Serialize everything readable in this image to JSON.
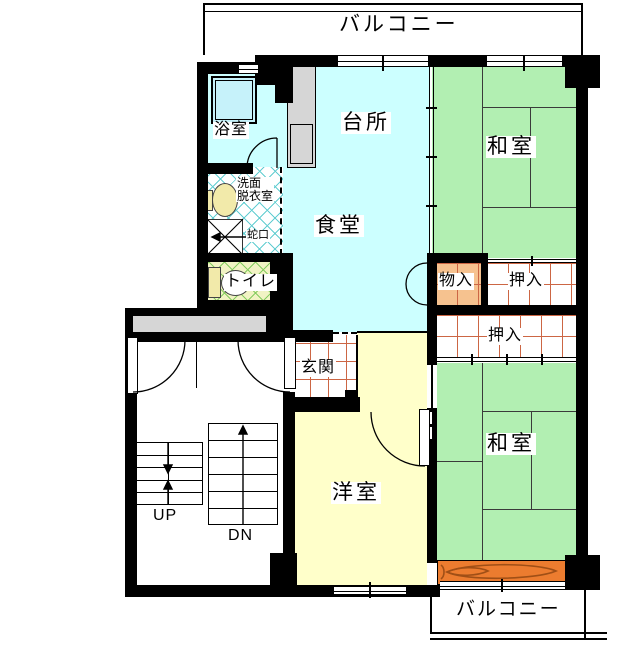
{
  "title": "apartment-floor-plan",
  "labels": {
    "balcony_top": "バルコニー",
    "balcony_bottom": "バルコニー",
    "bathroom": "浴室",
    "kitchen": "台所",
    "dining": "食堂",
    "washitsu_top": "和室",
    "washitsu_bottom": "和室",
    "western_room": "洋室",
    "washroom_line1": "洗面",
    "washroom_line2": "脱衣室",
    "faucet": "蛇口",
    "toilet": "トイレ",
    "storage": "物入",
    "closet_upper": "押入",
    "closet_lower": "押入",
    "entrance": "玄関",
    "stairs_up": "UP",
    "stairs_down": "DN"
  },
  "colors": {
    "room_cyan": "#ccffff",
    "tatami_green": "#b2efb2",
    "room_yellow": "#ffffca",
    "storage_orange": "#f6c28f",
    "wood_floor_orange": "#ec7c2f",
    "grid_line_red": "#cc6644",
    "lattice_cyan": "#62cdd1",
    "lattice_green_line": "#85cc60",
    "lattice_green_bg": "#f1f3c4",
    "counter_gray": "#d6d6d6",
    "wall_black": "#000000"
  }
}
